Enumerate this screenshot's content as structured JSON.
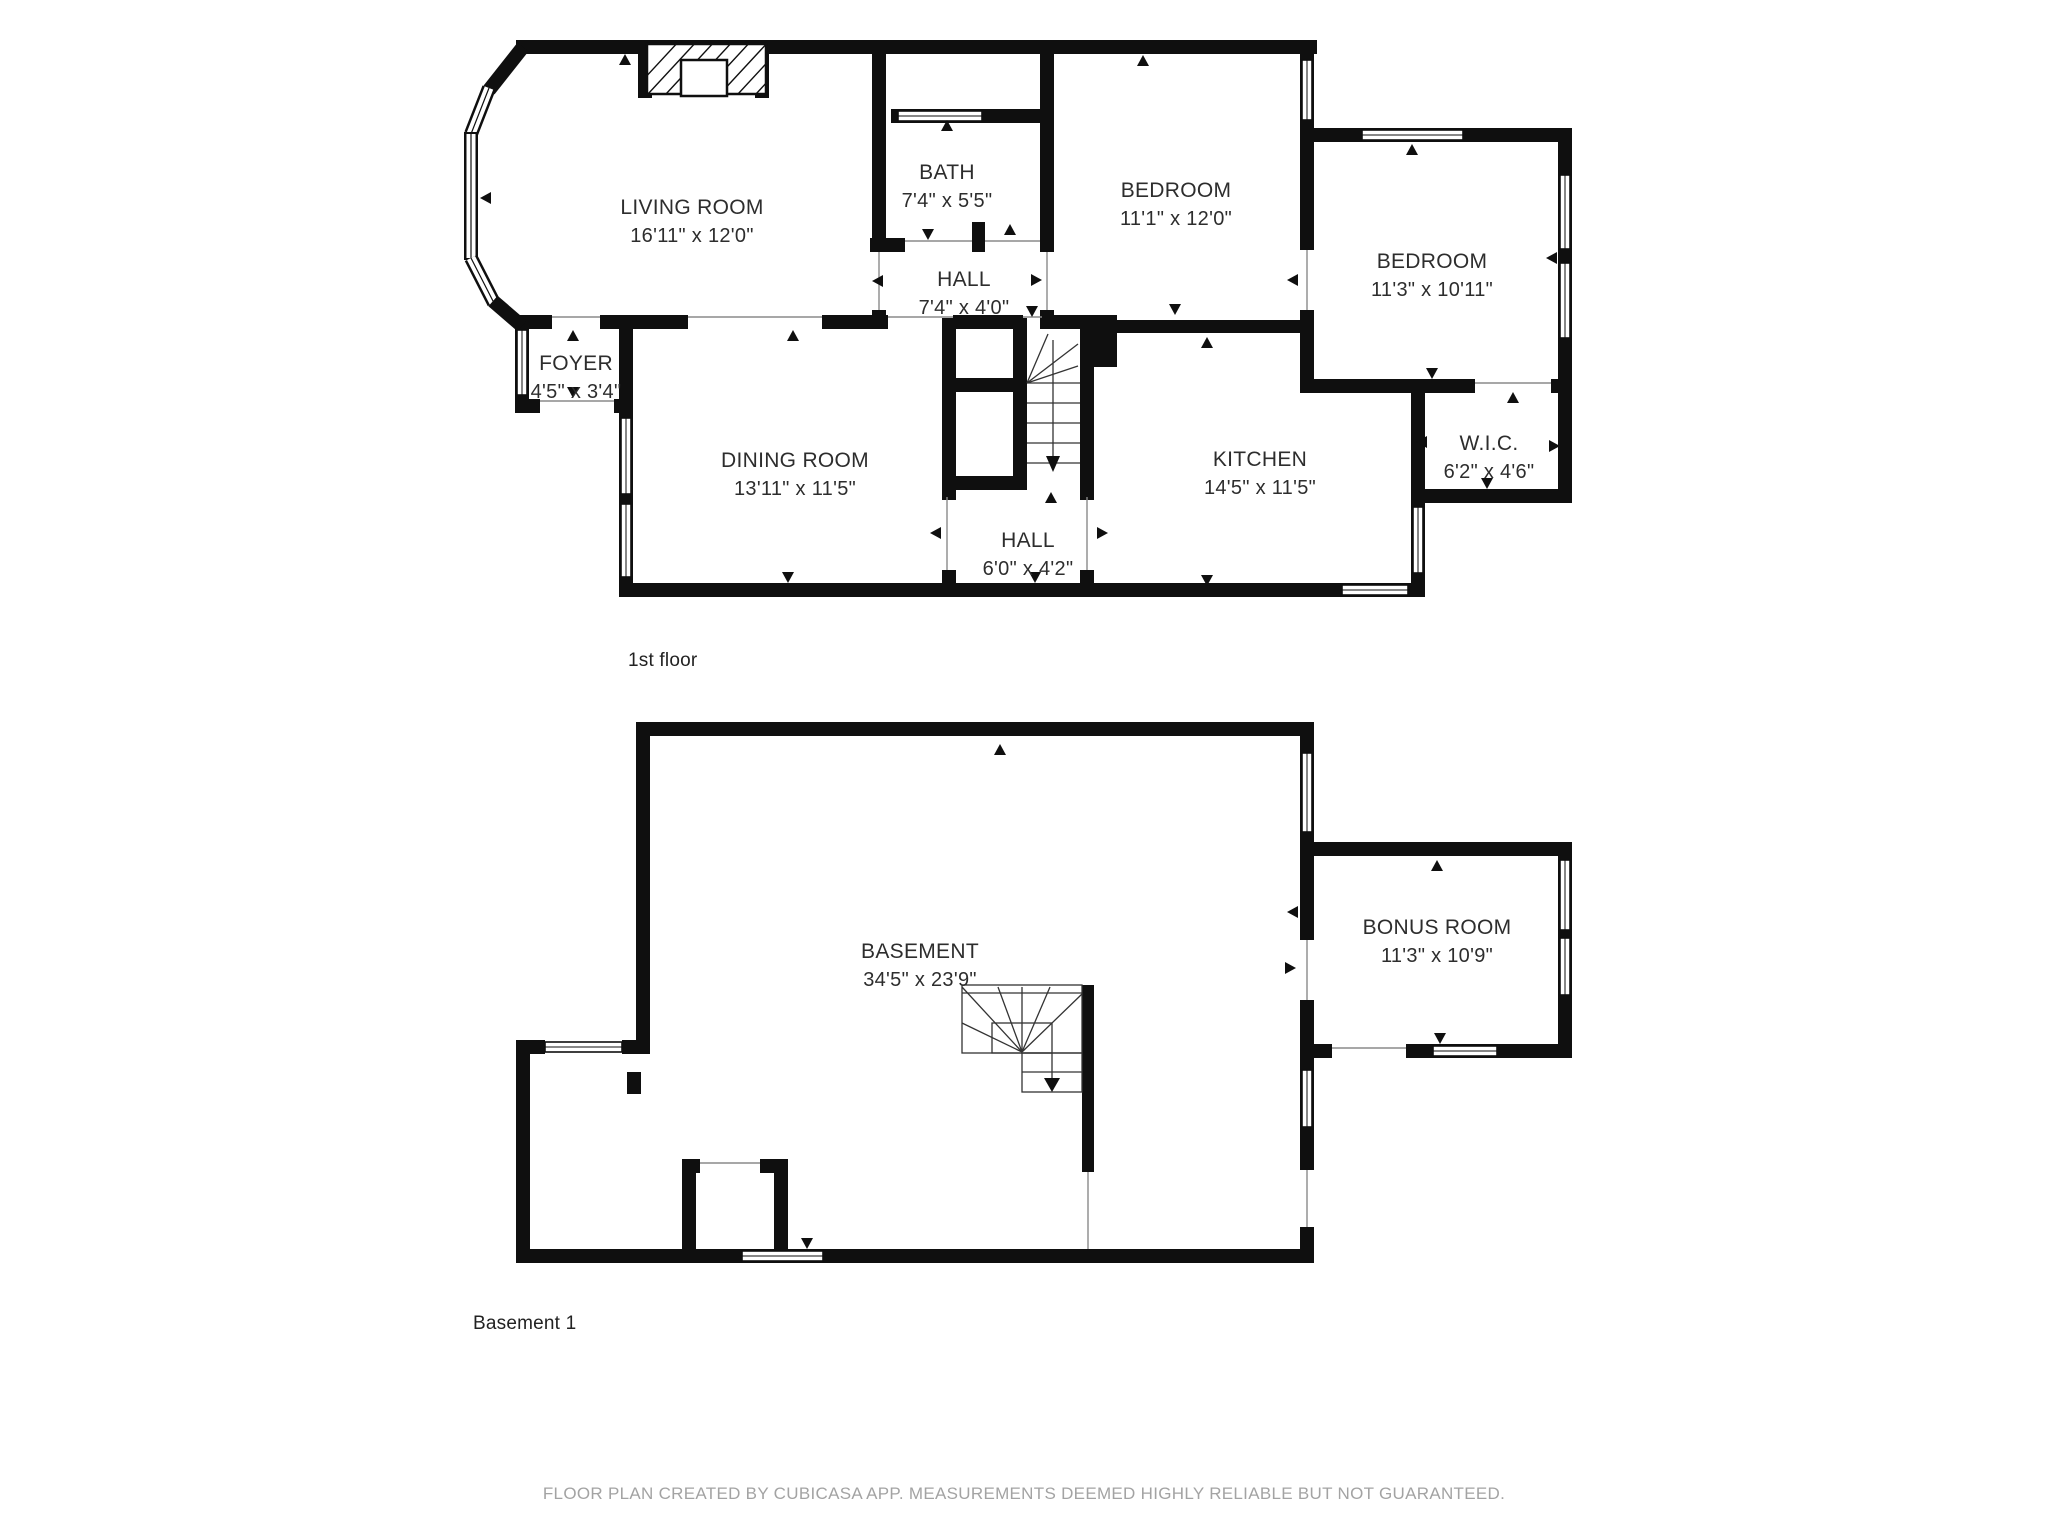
{
  "document": {
    "type": "floor-plan",
    "creator_note": "FLOOR PLAN CREATED BY CUBICASA APP. MEASUREMENTS DEEMED HIGHLY RELIABLE BUT NOT GUARANTEED."
  },
  "colors": {
    "wall": "#0f0f0f",
    "room_label": "#2d2d2d",
    "floor_title": "#222222",
    "footer_text": "#a3a3a3",
    "background": "#ffffff"
  },
  "icons": {
    "stairs": "stairs-icon",
    "fireplace": "fireplace-icon",
    "window": "window-icon",
    "door_marker": "door-direction-marker-icon"
  },
  "floors": [
    {
      "title": "1st floor",
      "rooms": [
        {
          "name": "LIVING ROOM",
          "dims": "16'11\" x 12'0\""
        },
        {
          "name": "BATH",
          "dims": "7'4\" x 5'5\""
        },
        {
          "name": "HALL",
          "dims": "7'4\" x 4'0\""
        },
        {
          "name": "BEDROOM",
          "dims": "11'1\" x 12'0\""
        },
        {
          "name": "BEDROOM",
          "dims": "11'3\" x 10'11\""
        },
        {
          "name": "FOYER",
          "dims": "4'5\" x 3'4\""
        },
        {
          "name": "DINING ROOM",
          "dims": "13'11\" x 11'5\""
        },
        {
          "name": "KITCHEN",
          "dims": "14'5\" x 11'5\""
        },
        {
          "name": "HALL",
          "dims": "6'0\" x 4'2\""
        },
        {
          "name": "W.I.C.",
          "dims": "6'2\" x 4'6\""
        }
      ]
    },
    {
      "title": "Basement 1",
      "rooms": [
        {
          "name": "BASEMENT",
          "dims": "34'5\" x 23'9\""
        },
        {
          "name": "BONUS ROOM",
          "dims": "11'3\" x 10'9\""
        }
      ]
    }
  ],
  "footer": {
    "text": "FLOOR PLAN CREATED BY CUBICASA APP. MEASUREMENTS DEEMED HIGHLY RELIABLE BUT NOT GUARANTEED."
  }
}
